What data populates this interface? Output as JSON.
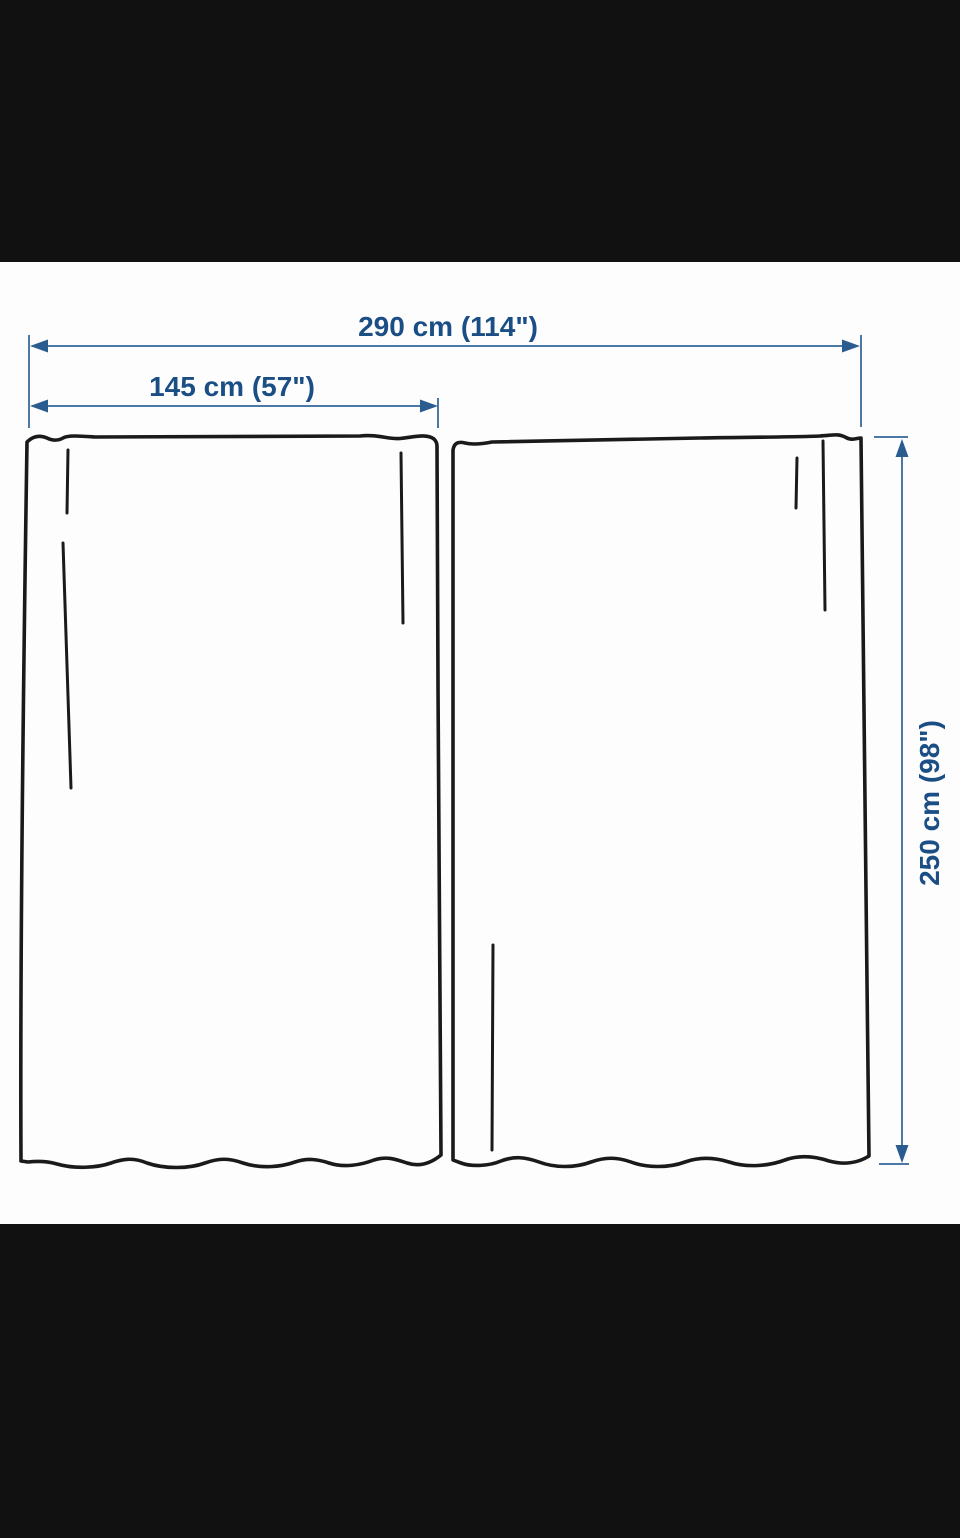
{
  "page": {
    "letterbox_color": "#111111",
    "canvas_color": "#fdfdfd"
  },
  "diagram": {
    "kind": "curtain-pair-dimension-diagram",
    "labels": {
      "total_width": "290 cm (114\")",
      "panel_width": "145 cm (57\")",
      "panel_height": "250 cm (98\")"
    },
    "values": {
      "total_width_cm": 290,
      "total_width_in": 114,
      "panel_width_cm": 145,
      "panel_width_in": 57,
      "panel_height_cm": 250,
      "panel_height_in": 98
    },
    "colors": {
      "dimension_line": "#4c78a6",
      "arrowhead": "#2b5c8f",
      "label_text": "#1a4e85",
      "outline": "#1a1a1a",
      "panel_fill": "#fdfdfd"
    }
  }
}
